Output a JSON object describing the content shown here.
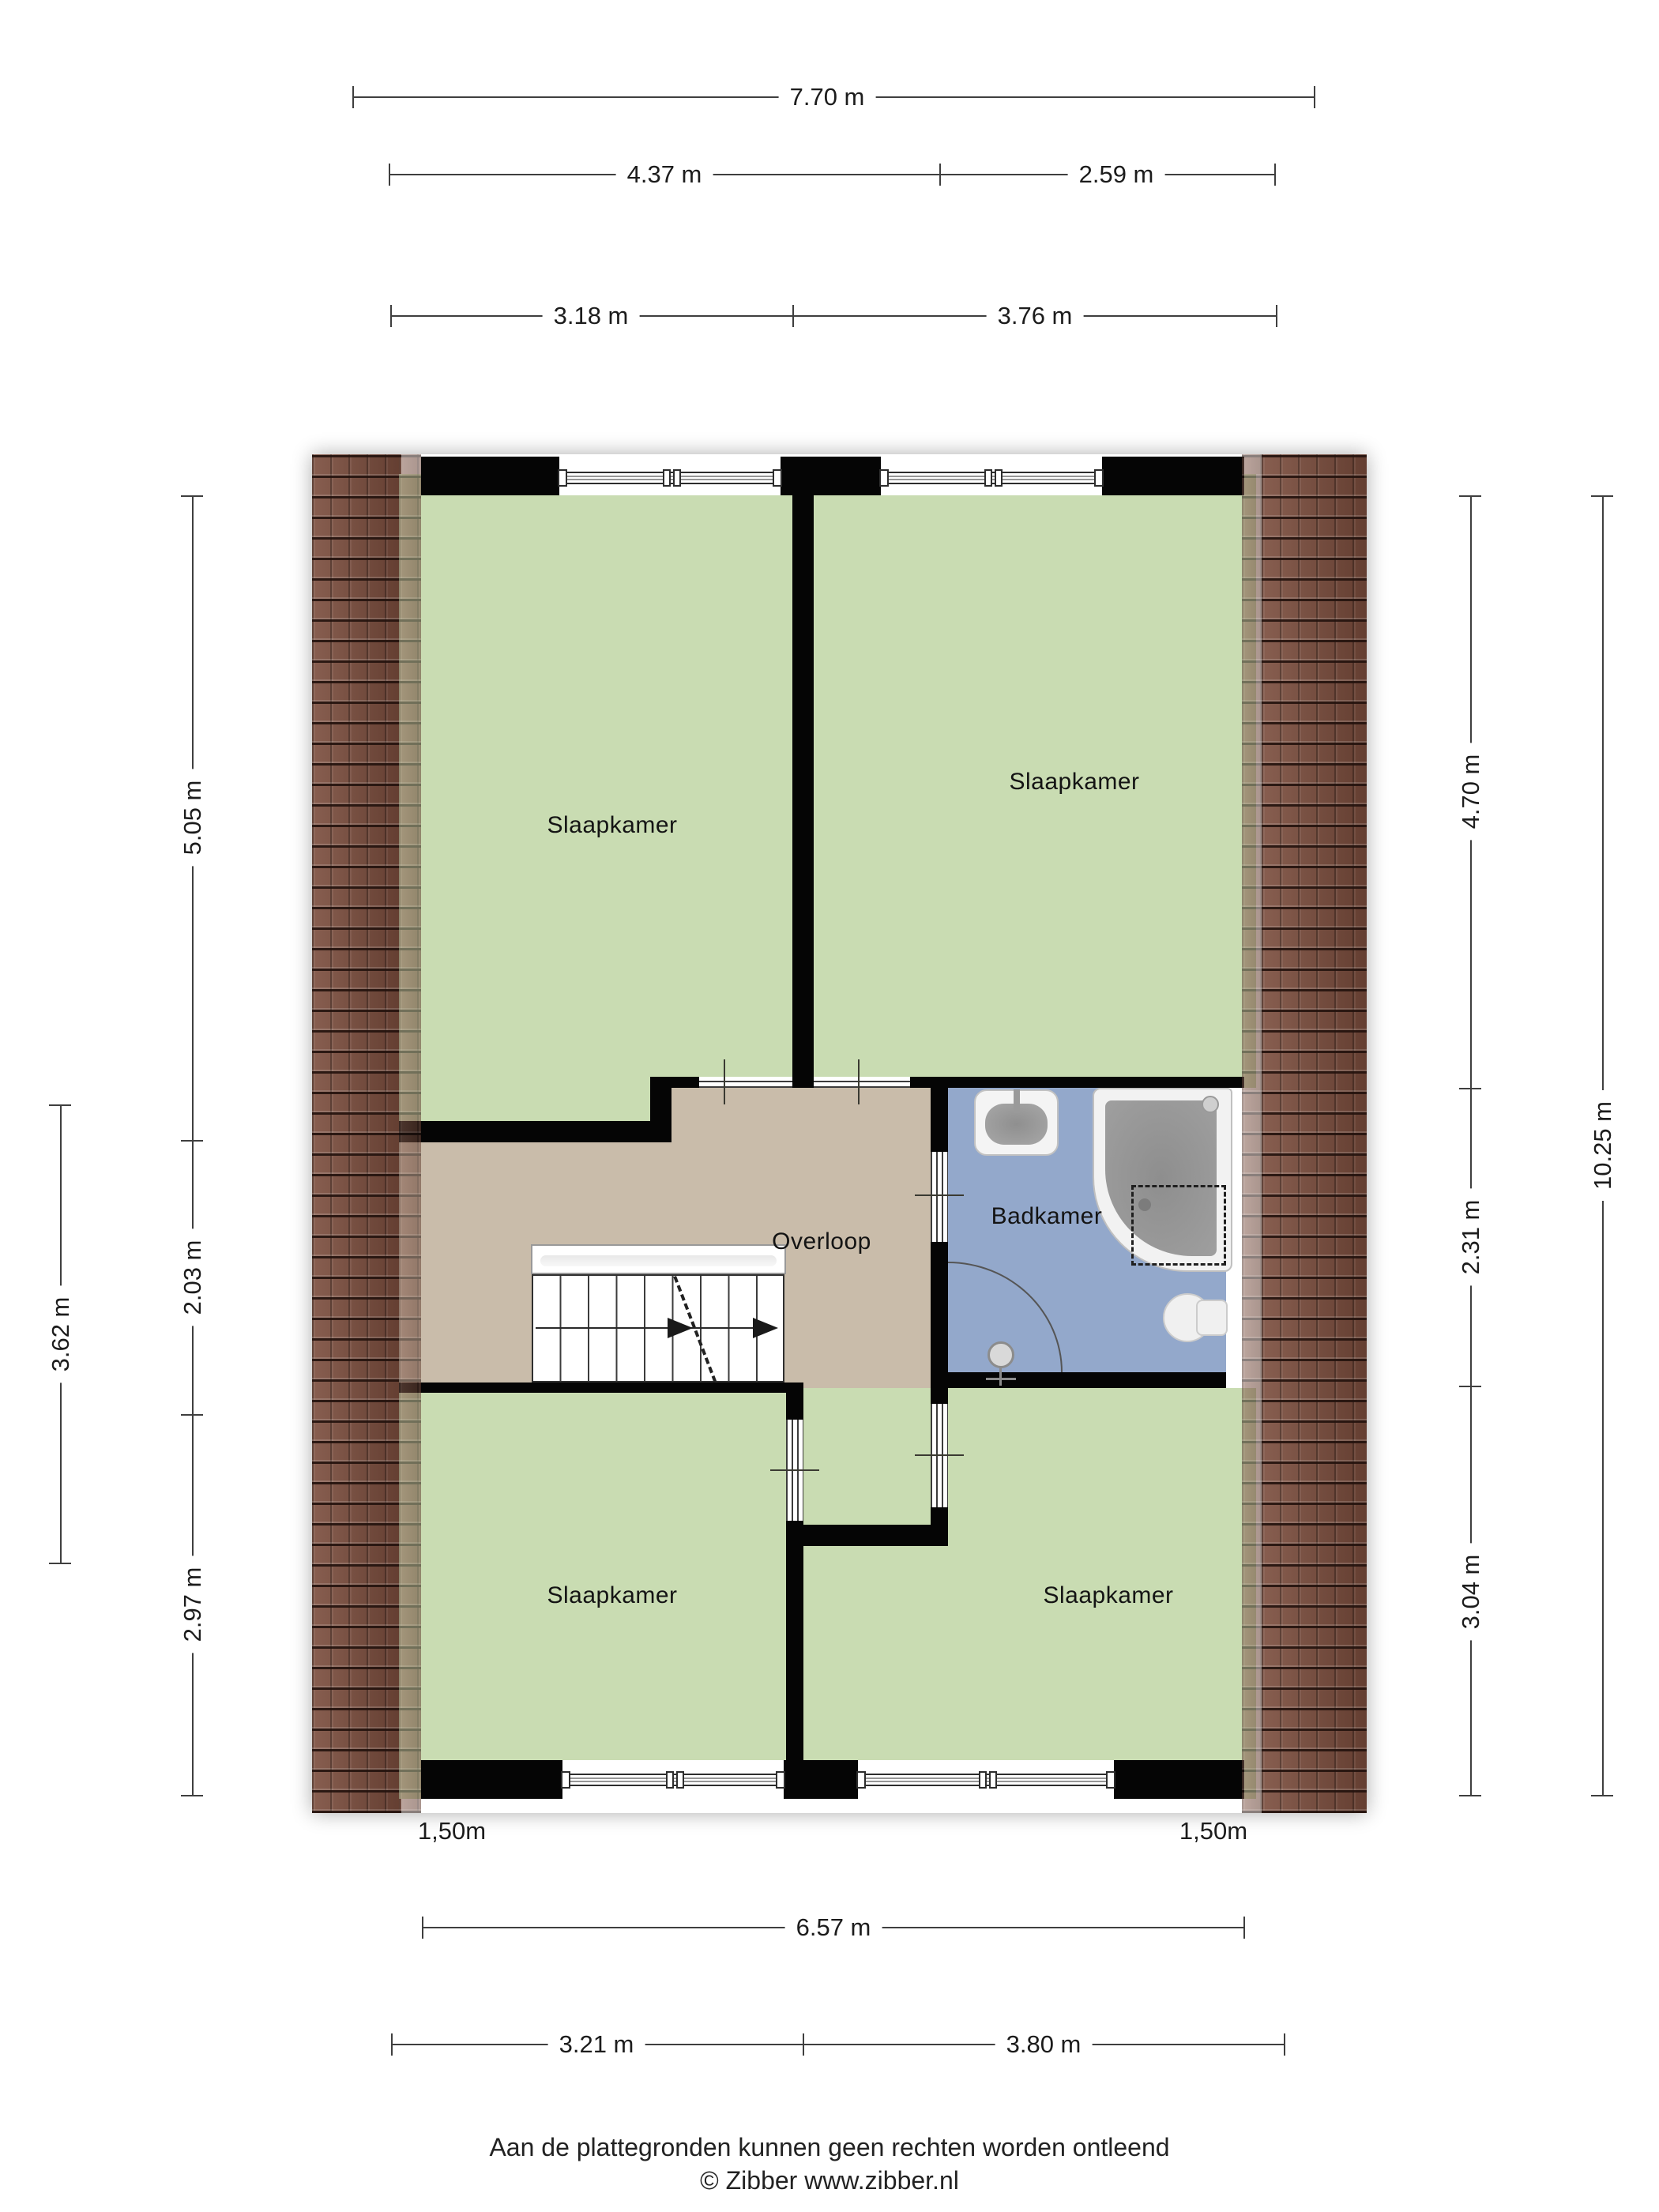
{
  "dims": {
    "top": {
      "total": "7.70 m",
      "row2_left": "4.37 m",
      "row2_right": "2.59 m",
      "row3_left": "3.18 m",
      "row3_right": "3.76 m"
    },
    "left": {
      "top": "5.05 m",
      "middle": "2.03 m",
      "bottom": "2.97 m",
      "outer": "3.62 m"
    },
    "right": {
      "top": "4.70 m",
      "middle": "2.31 m",
      "bottom": "3.04 m",
      "outer": "10.25 m"
    },
    "bottom": {
      "total": "6.57 m",
      "left": "3.21 m",
      "right": "3.80 m",
      "eave_left": "1,50m",
      "eave_right": "1,50m"
    }
  },
  "rooms": {
    "bedroom_top_left": "Slaapkamer",
    "bedroom_top_right": "Slaapkamer",
    "landing": "Overloop",
    "bathroom": "Badkamer",
    "bedroom_bottom_left": "Slaapkamer",
    "bedroom_bottom_right": "Slaapkamer"
  },
  "footer": {
    "disclaimer": "Aan de plattegronden kunnen geen rechten worden ontleend",
    "copyright": "© Zibber www.zibber.nl"
  },
  "colors": {
    "room_green": "#c9dcb2",
    "landing_tan": "#c9bcaa",
    "bathroom_blue": "#93a8cb",
    "roof_tile_brown": "#7a4c3c",
    "wall_black": "#050505",
    "dimension_gray": "#3f3f3f"
  }
}
